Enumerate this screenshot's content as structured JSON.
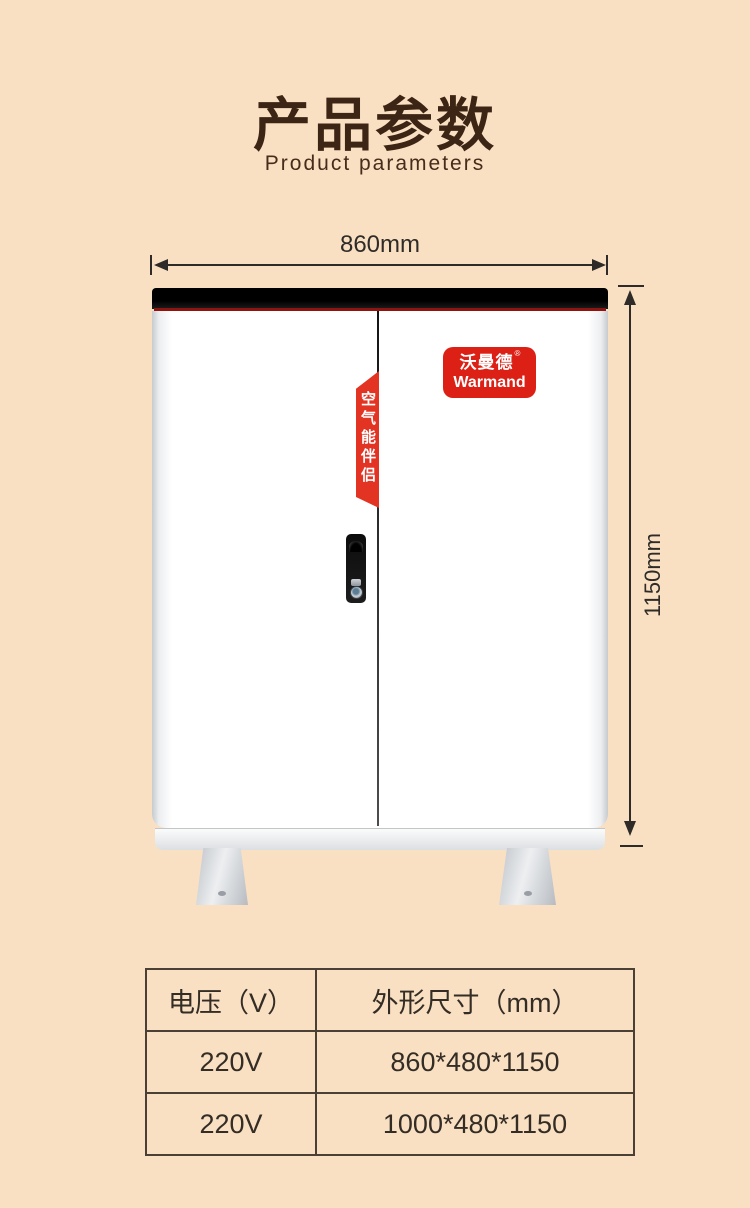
{
  "header": {
    "title": "产品参数",
    "subtitle": "Product parameters"
  },
  "dimensions": {
    "width_label": "860mm",
    "height_label": "1150mm"
  },
  "product": {
    "ribbon_text": "空气能伴侣",
    "badge_cn": "沃曼德",
    "badge_reg": "®",
    "badge_en": "Warmand"
  },
  "colors": {
    "background": "#fae0c2",
    "title_brown": "#3c2514",
    "accent_red": "#dd2015",
    "dimension_line": "#2e2b28"
  },
  "spec_table": {
    "headers": [
      "电压（V）",
      "外形尺寸（mm）"
    ],
    "rows": [
      [
        "220V",
        "860*480*1150"
      ],
      [
        "220V",
        "1000*480*1150"
      ]
    ]
  }
}
